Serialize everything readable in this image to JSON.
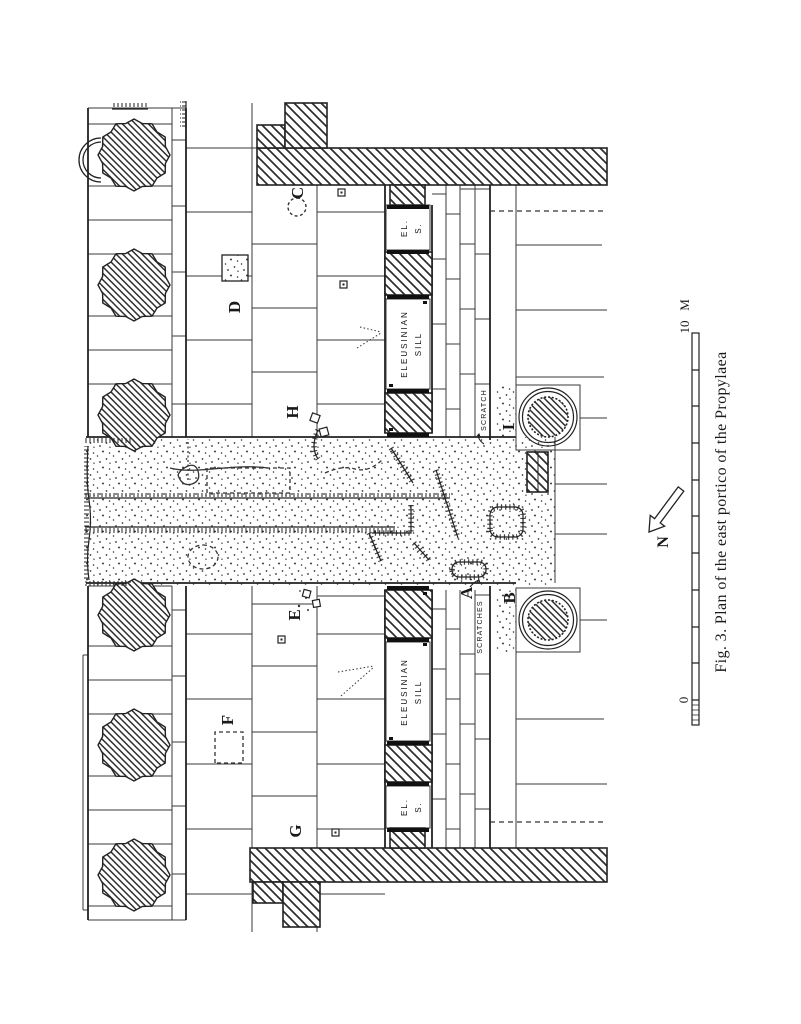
{
  "figure": {
    "caption": "Fig. 3.  Plan of the east portico of the Propylaea",
    "plan_labels": {
      "a": "A",
      "b": "B",
      "c": "C",
      "d": "D",
      "e": "E",
      "f": "F",
      "g": "G",
      "h": "H",
      "i": "I"
    },
    "inscriptions": {
      "eleusinian": "ELEUSINIAN",
      "sill": "SILL",
      "el_abbrev": "EL.",
      "s_abbrev": "S.",
      "scratch": "SCRATCH",
      "scratches": "SCRATCHES"
    },
    "compass": {
      "north": "N"
    },
    "scale_bar": {
      "zero": "0",
      "max": "10",
      "unit": "M"
    },
    "colors": {
      "ink": "#1f1f1f",
      "paper": "#ffffff"
    }
  }
}
